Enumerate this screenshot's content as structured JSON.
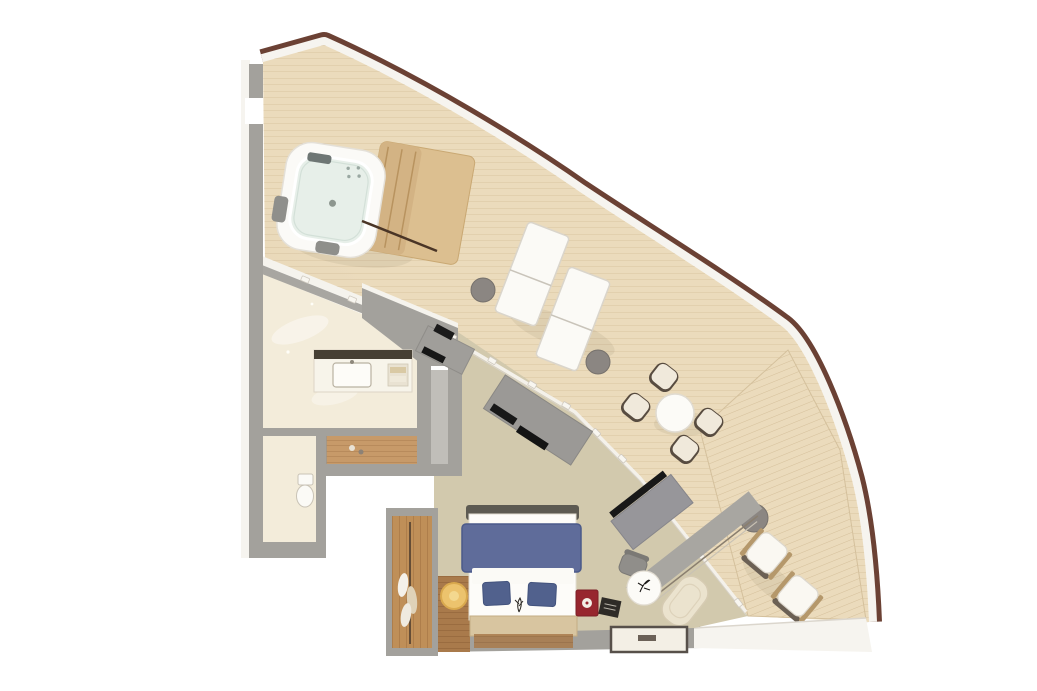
{
  "scene": {
    "kind": "3d-floor-plan-top-view",
    "description": "curved suite with wraparound balcony deck"
  },
  "colors": {
    "background": "#ffffff",
    "hull_trim": "#6b4134",
    "wall_white": "#f6f4ef",
    "wall_gray": "#a3a19c",
    "wall_gray_dark": "#8d897f",
    "deck_wood": "#ebdbbc",
    "deck_plank_line": "#d8c4a1",
    "carpet": "#d2c9ad",
    "bathroom_floor": "#f3ecda",
    "teak_floor": "#c79a69",
    "closet_wood": "#bf8f58",
    "threshold_wood": "#a97a4b",
    "hot_tub_shell": "#fbfaf7",
    "hot_tub_water": "#e7efe9",
    "steps_wood": "#dcbf90",
    "lounger_white": "#fbfaf6",
    "side_table_gray": "#8b8682",
    "dining_table_white": "#fcfbf7",
    "chair_cushion": "#f0e9db",
    "chair_frame_brown": "#584c40",
    "armchair_arm_wood": "#b5986b",
    "bed_duvet": "#5f6c9a",
    "bed_pillow": "#51618d",
    "bed_mattress": "#fdfcf9",
    "headboard_tan": "#d8c5a0",
    "bed_foot_frame": "#5d5a52",
    "pouf_yellow": "#ecc36d",
    "cabinet_red": "#97262e",
    "chaise_cream": "#ebe3ce",
    "rug_white": "#f3efe5",
    "rug_border": "#57504a",
    "desk_gray": "#97969a",
    "tv_black": "#181818",
    "door_panel_gray": "#a8a6a1"
  },
  "balcony": {
    "name": "balcony-deck",
    "furniture": [
      {
        "name": "hot-tub",
        "count": 1
      },
      {
        "name": "hot-tub-steps-platform",
        "count": 1
      },
      {
        "name": "handrail",
        "count": 1
      },
      {
        "name": "sun-lounger",
        "count": 2
      },
      {
        "name": "round-side-table",
        "count": 3
      },
      {
        "name": "dining-table",
        "count": 1
      },
      {
        "name": "dining-chair",
        "count": 4
      },
      {
        "name": "cushioned-armchair",
        "count": 2
      }
    ]
  },
  "interior": {
    "rooms": [
      {
        "name": "bathroom",
        "furniture": [
          {
            "name": "vanity-counter"
          },
          {
            "name": "sink"
          },
          {
            "name": "mirror"
          },
          {
            "name": "shower-teak-floor"
          }
        ]
      },
      {
        "name": "toilet-room",
        "furniture": [
          {
            "name": "toilet"
          }
        ]
      },
      {
        "name": "wardrobe",
        "furniture": [
          {
            "name": "clothes-rod"
          },
          {
            "name": "hanging-clothes",
            "count": 3
          }
        ]
      },
      {
        "name": "living-area",
        "furniture": [
          {
            "name": "tv-console"
          },
          {
            "name": "wall-tv"
          },
          {
            "name": "sliding-door-panel",
            "count": 2
          },
          {
            "name": "desk-tv-unit"
          },
          {
            "name": "desk-chair"
          },
          {
            "name": "decor-table"
          },
          {
            "name": "chaise-chair"
          },
          {
            "name": "rug"
          }
        ]
      },
      {
        "name": "bedroom",
        "furniture": [
          {
            "name": "double-bed"
          },
          {
            "name": "duvet"
          },
          {
            "name": "pillow",
            "count": 2
          },
          {
            "name": "headboard"
          },
          {
            "name": "foot-bench"
          },
          {
            "name": "yellow-pouf"
          },
          {
            "name": "red-mini-cabinet"
          },
          {
            "name": "dark-tray"
          },
          {
            "name": "wood-threshold"
          }
        ]
      }
    ]
  }
}
